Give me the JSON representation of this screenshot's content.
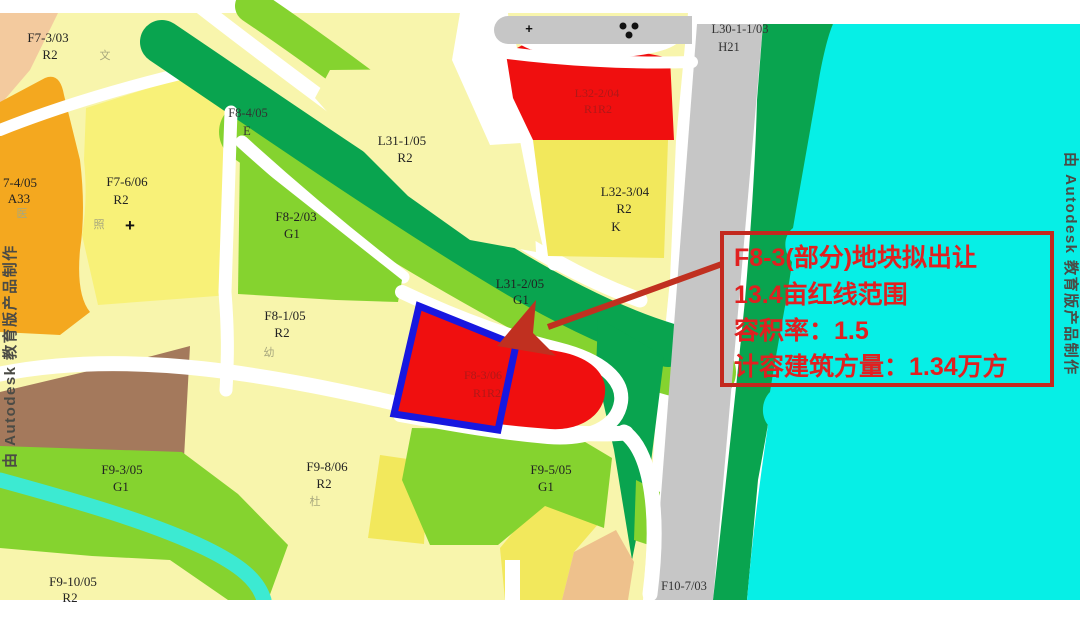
{
  "watermark_left": "由 Autodesk 教育版产品制作",
  "watermark_right": "由 Autodesk 教育版产品制作",
  "callout": {
    "lines": [
      "F8-3(部分)地块拟出让",
      "13.4亩红线范围",
      "容积率：1.5",
      "计容建筑方量：1.34万方"
    ]
  },
  "parcels": {
    "f7_3": {
      "id": "F7-3/03",
      "code": "R2",
      "note": "文"
    },
    "f7_4": {
      "id": "7-4/05",
      "code": "A33",
      "note": "医"
    },
    "f7_6": {
      "id": "F7-6/06",
      "code": "R2",
      "note": "照"
    },
    "f8_4": {
      "id": "F8-4/05",
      "code": "E"
    },
    "f8_2": {
      "id": "F8-2/03",
      "code": "G1"
    },
    "f8_1": {
      "id": "F8-1/05",
      "code": "R2",
      "note": "幼"
    },
    "l31_1": {
      "id": "L31-1/05",
      "code": "R2"
    },
    "l31_2": {
      "id": "L31-2/05",
      "code": "G1"
    },
    "l32_2": {
      "id": "L32-2/04",
      "code": "R1R2"
    },
    "l32_3": {
      "id": "L32-3/04",
      "code": "R2",
      "note": "K"
    },
    "l30_1_1": {
      "id": "L30-1-1/03",
      "code": "H21"
    },
    "f8_3": {
      "id": "F8-3/06",
      "code": "R1R2"
    },
    "f9_3": {
      "id": "F9-3/05",
      "code": "G1"
    },
    "f9_8": {
      "id": "F9-8/06",
      "code": "R2",
      "note": "杜"
    },
    "f9_5": {
      "id": "F9-5/05",
      "code": "G1"
    },
    "f9_10": {
      "id": "F9-10/05",
      "code": "R2"
    },
    "f10_7": {
      "id": "F10-7/03"
    }
  },
  "markers": {
    "plus": "+",
    "cross": "+"
  },
  "colors": {
    "water": "#06EFE6",
    "stream": "#3CEAD2",
    "residential_pale": "#F8F5AC",
    "residential_yellow": "#F2E85C",
    "green_space": "#85D32F",
    "protective_green": "#09A44F",
    "road_gray": "#C6C6C6",
    "road_white": "#FFFFFF",
    "parcel_red": "#F00F0F",
    "redline_blue": "#1717E0",
    "highlight_red": "#E02020",
    "orange_parcel": "#F4A81F",
    "brown_parcel": "#A4795C"
  }
}
